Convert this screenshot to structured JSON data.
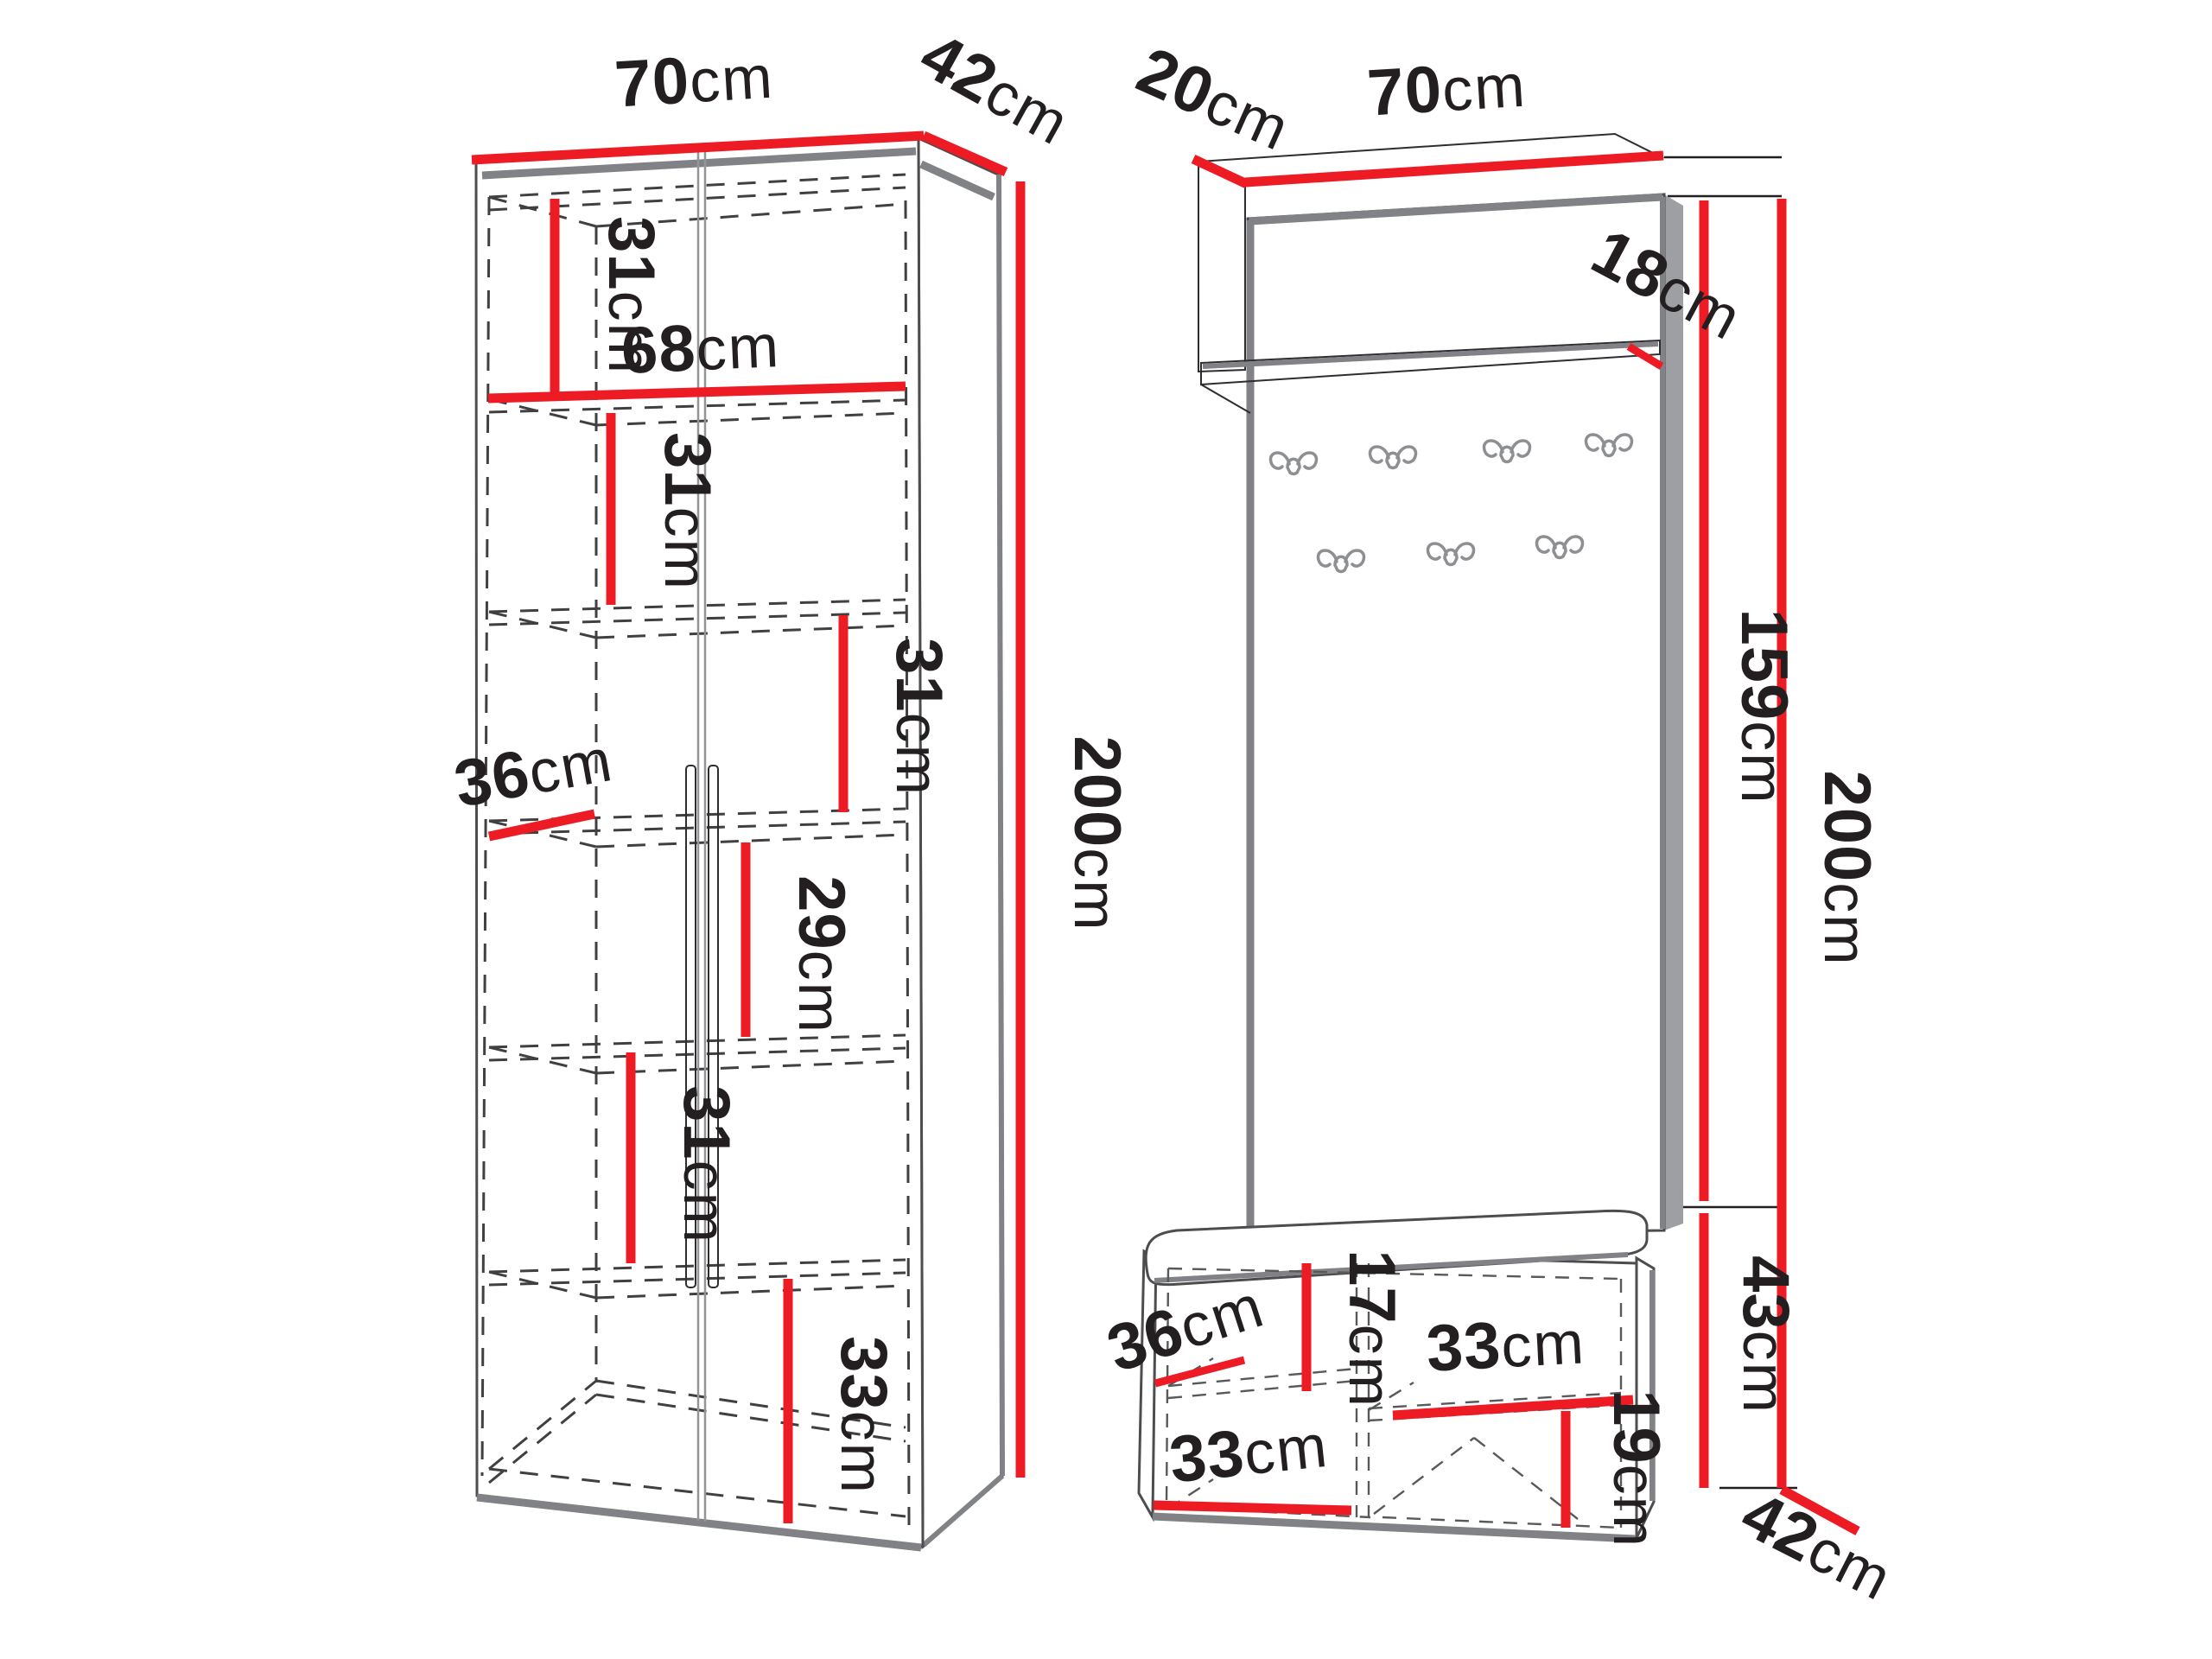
{
  "diagram": {
    "type": "furniture-dimension-diagram",
    "background": "#ffffff",
    "colors": {
      "dimension_red": "#ec1b24",
      "outline_black": "#231f20",
      "carcass_gray": "#808285",
      "dash_gray": "#404041"
    }
  },
  "wardrobe": {
    "labels": {
      "width": {
        "value": "70",
        "unit": "cm"
      },
      "depth": {
        "value": "42",
        "unit": "cm"
      },
      "height": {
        "value": "200",
        "unit": "cm"
      },
      "interior_width": {
        "value": "68",
        "unit": "cm"
      },
      "shelf_depth": {
        "value": "36",
        "unit": "cm"
      },
      "compartment_1": {
        "value": "31",
        "unit": "cm"
      },
      "compartment_2": {
        "value": "31",
        "unit": "cm"
      },
      "compartment_3": {
        "value": "31",
        "unit": "cm"
      },
      "compartment_4": {
        "value": "29",
        "unit": "cm"
      },
      "compartment_5": {
        "value": "31",
        "unit": "cm"
      },
      "compartment_6": {
        "value": "33",
        "unit": "cm"
      }
    }
  },
  "hallway": {
    "hook_count": 7,
    "labels": {
      "shelf_depth": {
        "value": "20",
        "unit": "cm"
      },
      "shelf_width": {
        "value": "70",
        "unit": "cm"
      },
      "shelf_height": {
        "value": "18",
        "unit": "cm"
      },
      "panel_height": {
        "value": "159",
        "unit": "cm"
      },
      "total_height": {
        "value": "200",
        "unit": "cm"
      },
      "bench_height": {
        "value": "43",
        "unit": "cm"
      },
      "bench_depth": {
        "value": "42",
        "unit": "cm"
      },
      "bench_shelf_depth": {
        "value": "36",
        "unit": "cm"
      },
      "bench_upper_height": {
        "value": "17",
        "unit": "cm"
      },
      "bench_right_width": {
        "value": "33",
        "unit": "cm"
      },
      "bench_lower_height": {
        "value": "19",
        "unit": "cm"
      },
      "bench_left_width": {
        "value": "33",
        "unit": "cm"
      }
    }
  }
}
